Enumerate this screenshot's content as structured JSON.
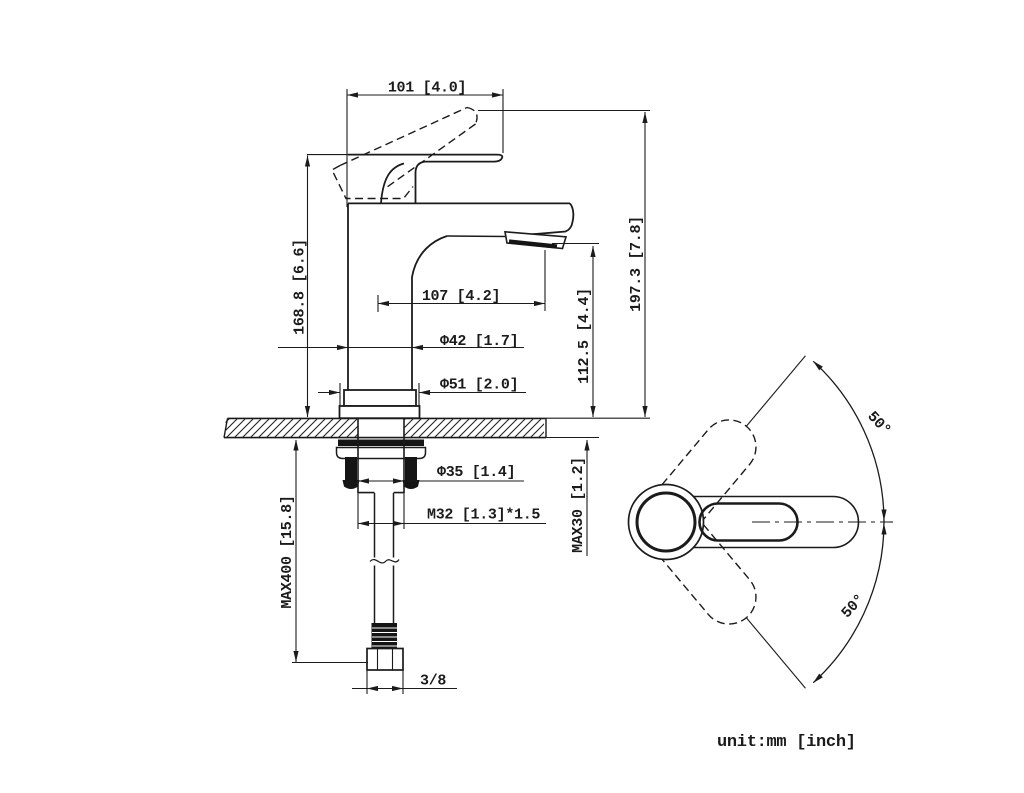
{
  "drawing": {
    "colors": {
      "line": "#1b1b1b",
      "background": "#ffffff"
    },
    "unit_note": "unit:mm [inch]",
    "front_view": {
      "dimensions": {
        "handle_length": "101 [4.0]",
        "body_height": "168.8 [6.6]",
        "spout_reach": "107 [4.2]",
        "body_diameter": "Φ42 [1.7]",
        "base_diameter": "Φ51 [2.0]",
        "spout_outlet_height": "112.5 [4.4]",
        "overall_height": "197.3 [7.8]",
        "shank_diameter": "Φ35 [1.4]",
        "mounting_thread": "M32 [1.3]*1.5",
        "max_deck_thickness": "MAX30 [1.2]",
        "supply_hose_length": "MAX400 [15.8]",
        "hose_connection": "3/8"
      }
    },
    "top_view": {
      "handle_swing_upper": "50°",
      "handle_swing_lower": "50°"
    }
  }
}
